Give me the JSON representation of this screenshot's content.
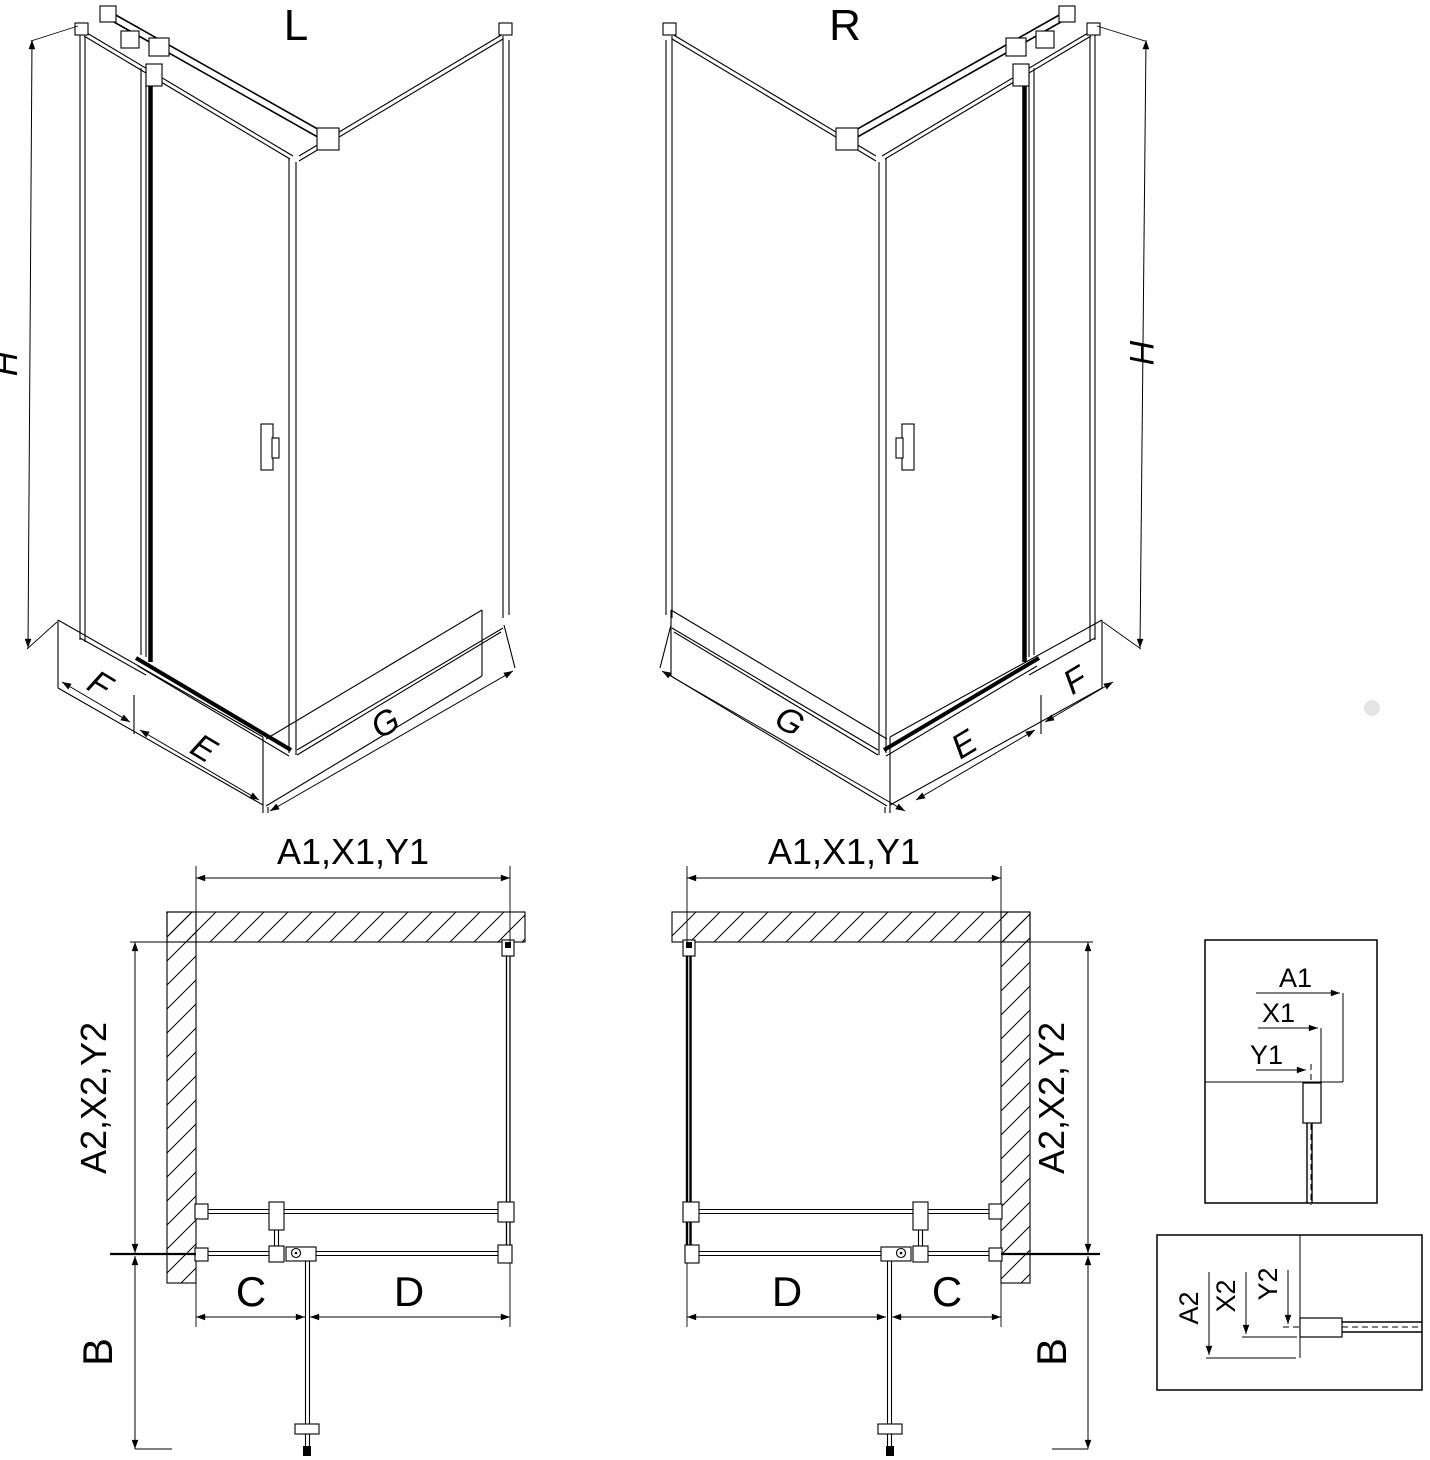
{
  "left_view": {
    "title": "L",
    "h": "H",
    "f": "F",
    "e": "E",
    "g": "G"
  },
  "right_view": {
    "title": "R",
    "h": "H",
    "f": "F",
    "e": "E",
    "g": "G"
  },
  "left_plan": {
    "width_dim": "A1,X1,Y1",
    "side_dim": "A2,X2,Y2",
    "c": "C",
    "d": "D",
    "b": "B"
  },
  "right_plan": {
    "width_dim": "A1,X1,Y1",
    "side_dim": "A2,X2,Y2",
    "c": "C",
    "d": "D",
    "b": "B"
  },
  "detail_top": {
    "a1": "A1",
    "x1": "X1",
    "y1": "Y1"
  },
  "detail_bottom": {
    "a2": "A2",
    "x2": "X2",
    "y2": "Y2"
  },
  "colors": {
    "line": "#000000",
    "background": "#ffffff"
  }
}
